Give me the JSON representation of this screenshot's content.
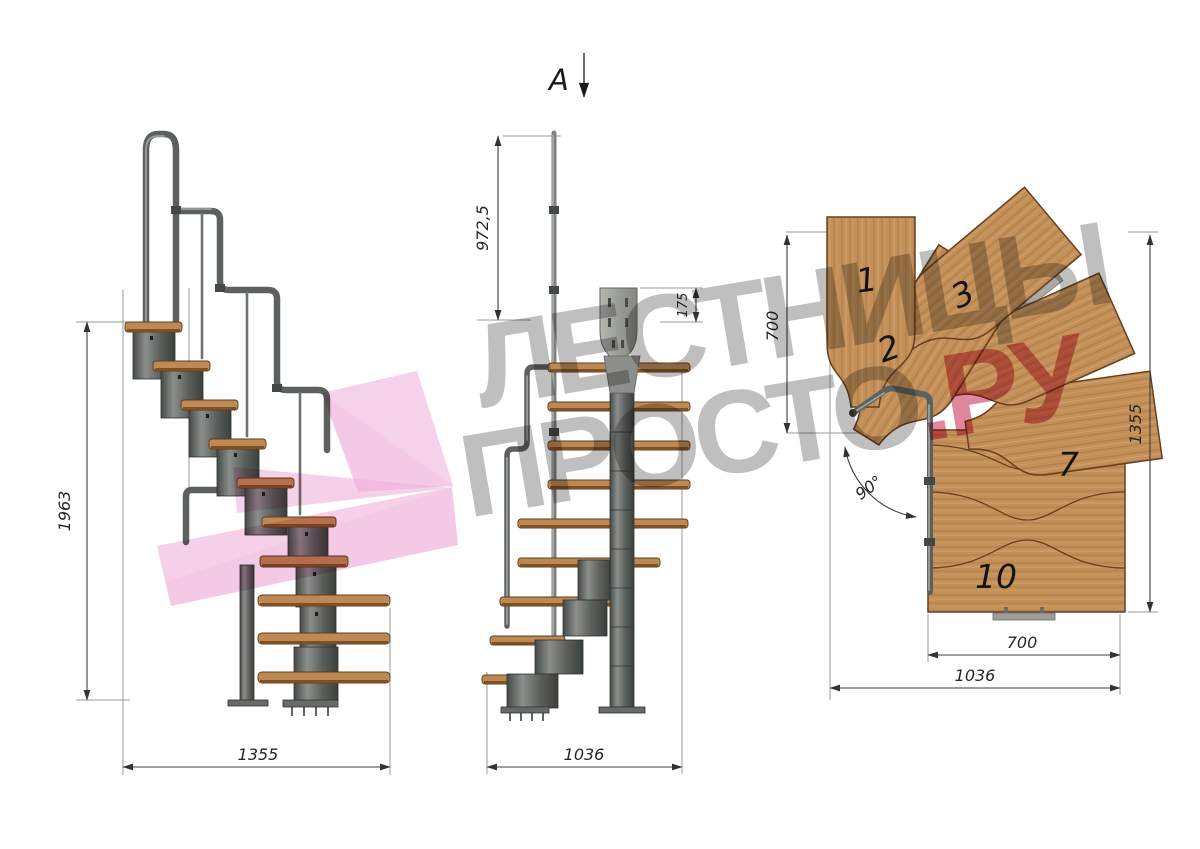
{
  "watermark": {
    "line1": "ЛЕСТНИЦЫ",
    "line2_gray": "ПРОСТО",
    "line2_accent": ".РУ",
    "gray_color": "#8a8a8a",
    "pink_color": "#f0bcdf",
    "accent_color": "#cd3e64"
  },
  "views": {
    "side": {
      "title": "side-elevation",
      "dims": {
        "height": "1963",
        "length": "1355"
      }
    },
    "front": {
      "title": "front-elevation",
      "section_label": "A",
      "dims": {
        "rail_height": "972,5",
        "bracket_height": "175",
        "length": "1036"
      }
    },
    "plan": {
      "title": "top-plan",
      "dims": {
        "upper_flight_depth": "700",
        "length": "1355",
        "lower_flight_width": "700",
        "total_width": "1036",
        "turn_angle": "90°"
      },
      "tread_labels": [
        "1",
        "2",
        "3",
        "7",
        "10"
      ]
    }
  },
  "colors": {
    "wood": "#c29058",
    "metal": "#5d615d",
    "dimension_lines": "#3c3c3c"
  }
}
